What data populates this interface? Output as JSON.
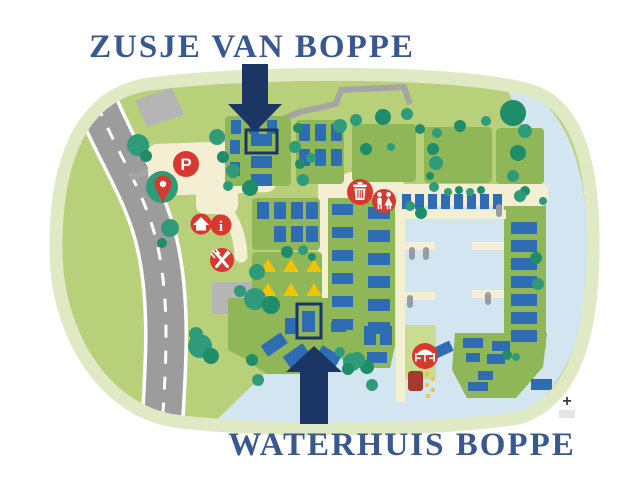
{
  "titles": {
    "zusje": "ZUSJE VAN BOPPE",
    "waterhuis": "WATERHUIS BOPPE"
  },
  "map": {
    "type": "holiday-park illustrated map",
    "highlighted_locations": [
      {
        "label": "ZUSJE VAN BOPPE",
        "marker": "navy box with down arrow",
        "area": "upper camp field"
      },
      {
        "label": "WATERHUIS BOPPE",
        "marker": "navy box with up arrow",
        "area": "waterfront field"
      }
    ],
    "icons": [
      {
        "name": "parking-icon",
        "glyph": "P"
      },
      {
        "name": "location-pin-icon"
      },
      {
        "name": "home-icon"
      },
      {
        "name": "info-icon",
        "glyph": "i"
      },
      {
        "name": "restaurant-icon"
      },
      {
        "name": "trash-icon"
      },
      {
        "name": "toilets-icon"
      },
      {
        "name": "beach-icon"
      }
    ],
    "controls": {
      "zoom_in": "+"
    }
  },
  "colors": {
    "navy": "#1b3565",
    "title-navy": "#3a5890",
    "icon-red": "#d7382f",
    "dark-red": "#a8382e",
    "tree-teal": "#2f9b7a",
    "tree-dark": "#1f8c6a",
    "park-green": "#b8d07a",
    "field-green": "#8fb757",
    "rim-green": "#dfe9c4",
    "light-patch": "#c9dc92",
    "water": "#d3e5f0",
    "cream": "#f4efd3",
    "road-gray": "#9c9c9c",
    "path-gray": "#a5a5a5",
    "building-gray": "#b5b5b5",
    "cabin-blue": "#2e6cb4",
    "tent-yellow": "#f2c400",
    "boat-gray": "#979ca3",
    "dot-yellow": "#ecc440"
  }
}
